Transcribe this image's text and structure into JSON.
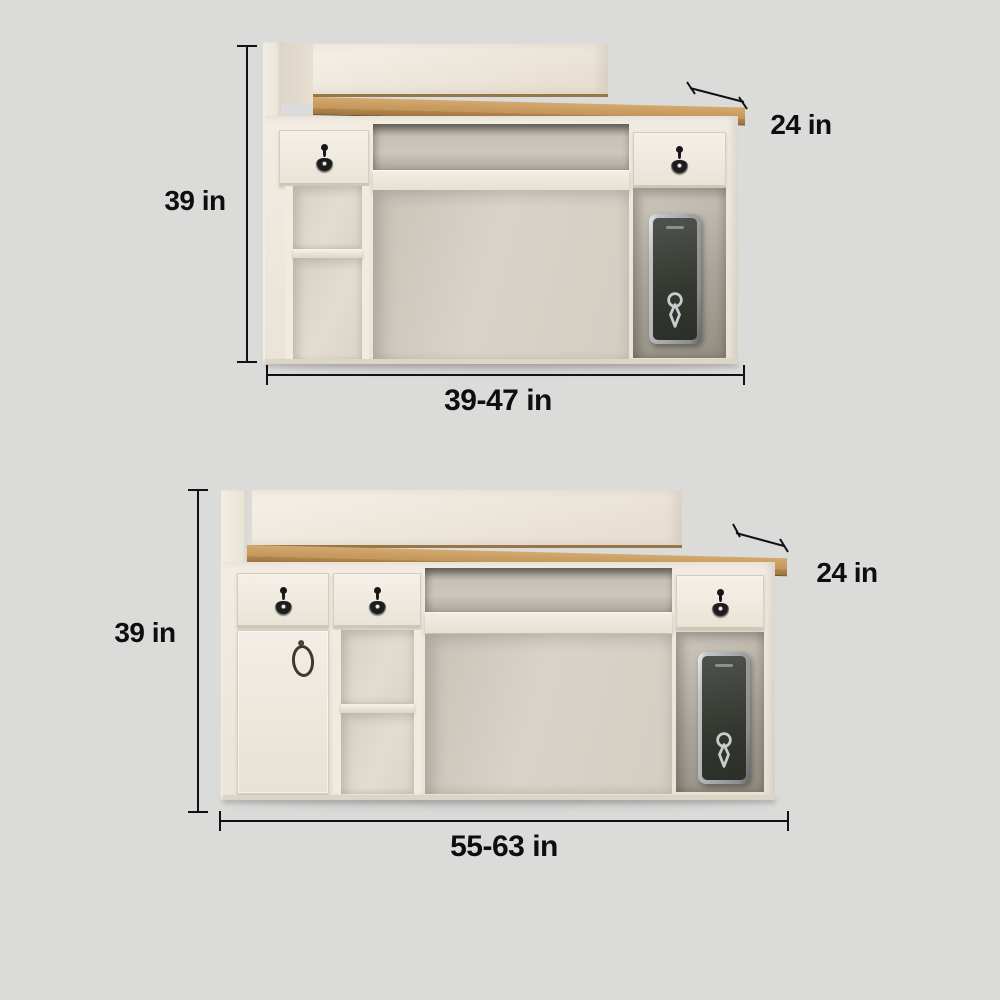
{
  "canvas": {
    "width": 1000,
    "height": 1000,
    "background": "#dbdbda"
  },
  "colors": {
    "dimension_lines": "#111111",
    "dimension_text": "#0e0e0e",
    "desk_body": "#f0eae1",
    "desk_top_wood": "#c99c60",
    "interior_shadow": "#a9a399",
    "device_body": "#3b3e38",
    "device_frame": "#c9cdcf"
  },
  "figures": [
    {
      "height_label": "39 in",
      "depth_label": "24 in",
      "width_label": "39-47 in"
    },
    {
      "height_label": "39 in",
      "depth_label": "24 in",
      "width_label": "55-63 in"
    }
  ]
}
